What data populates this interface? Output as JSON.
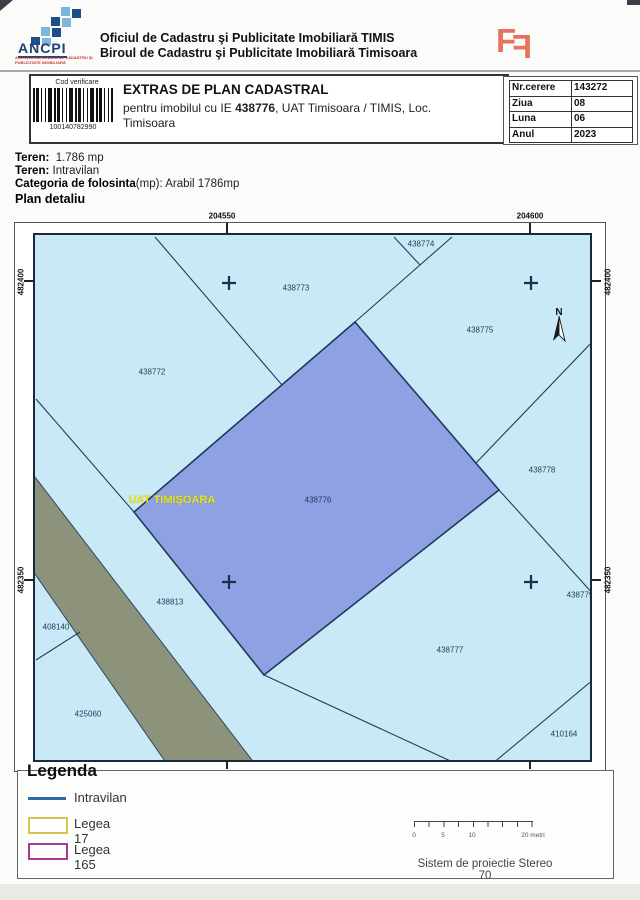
{
  "header": {
    "logo_acronym": "ANCPI",
    "logo_subtitle": "AGENŢIA NAŢIONALĂ DE CADASTRU ŞI PUBLICITATE IMOBILIARĂ",
    "office_line1": "Oficiul de Cadastru şi Publicitate Imobiliară TIMIS",
    "office_line2": "Biroul de Cadastru şi Publicitate Imobiliară Timisoara"
  },
  "title_box": {
    "cod_verificare": "Cod verificare",
    "barcode_number": "100140782990",
    "title": "EXTRAS DE PLAN CADASTRAL",
    "subtitle_prefix": "pentru imobilul cu IE ",
    "ie_number": "438776",
    "subtitle_suffix": ", UAT Timisoara / TIMIS, Loc.",
    "subtitle_line2": "Timisoara"
  },
  "request_table": [
    {
      "label": "Nr.cerere",
      "value": "143272"
    },
    {
      "label": "Ziua",
      "value": "08"
    },
    {
      "label": "Luna",
      "value": "06"
    },
    {
      "label": "Anul",
      "value": "2023"
    }
  ],
  "teren": {
    "label1": "Teren:",
    "value1": "1.786 mp",
    "label2": "Teren:",
    "value2": "Intravilan",
    "label3": "Categoria de folosinta",
    "label3b": "(mp):",
    "value3": "Arabil 1786mp",
    "plan_title": "Plan detaliu"
  },
  "map": {
    "grid_labels_top": [
      {
        "text": "204550",
        "x": 222,
        "y": 216
      },
      {
        "text": "204600",
        "x": 530,
        "y": 216
      }
    ],
    "grid_labels_bottom": [
      {
        "text": "204550",
        "x": 228,
        "y": 777
      },
      {
        "text": "204600",
        "x": 530,
        "y": 777
      }
    ],
    "grid_labels_left": [
      {
        "text": "482400",
        "x": 21,
        "y": 282
      },
      {
        "text": "482350",
        "x": 21,
        "y": 580
      }
    ],
    "grid_labels_right": [
      {
        "text": "482400",
        "x": 608,
        "y": 282
      },
      {
        "text": "482350",
        "x": 608,
        "y": 580
      }
    ],
    "parcels": [
      {
        "id": "438772",
        "x": 117,
        "y": 137
      },
      {
        "id": "438773",
        "x": 261,
        "y": 53
      },
      {
        "id": "438774",
        "x": 386,
        "y": 9
      },
      {
        "id": "438775",
        "x": 445,
        "y": 95
      },
      {
        "id": "438776",
        "x": 283,
        "y": 265
      },
      {
        "id": "438777",
        "x": 415,
        "y": 415
      },
      {
        "id": "438778",
        "x": 507,
        "y": 235
      },
      {
        "id": "438779",
        "x": 545,
        "y": 360
      },
      {
        "id": "438813",
        "x": 135,
        "y": 367
      },
      {
        "id": "408140",
        "x": 21,
        "y": 392
      },
      {
        "id": "425060",
        "x": 53,
        "y": 479
      },
      {
        "id": "410164",
        "x": 529,
        "y": 499
      }
    ],
    "uat_label": {
      "text": "UAT TIMIŞOARA",
      "x": 137,
      "y": 265
    },
    "north_label": "N",
    "crosses": [
      {
        "x": 194,
        "y": 48
      },
      {
        "x": 496,
        "y": 48
      },
      {
        "x": 194,
        "y": 347
      },
      {
        "x": 496,
        "y": 347
      }
    ]
  },
  "legend": {
    "title": "Legenda",
    "items": [
      {
        "label": "Intravilan",
        "swatch": "line",
        "color": "#2e6ca3"
      },
      {
        "label": "Legea 17",
        "swatch": "rect",
        "color": "#d2c553"
      },
      {
        "label": "Legea 165",
        "swatch": "rect",
        "color": "#a93a85"
      }
    ],
    "scale_labels": [
      {
        "text": "0",
        "x": 414
      },
      {
        "text": "5",
        "x": 443
      },
      {
        "text": "10",
        "x": 472
      },
      {
        "text": "20 metri",
        "x": 533
      }
    ],
    "projection": "Sistem de proiectie Stereo 70"
  },
  "colors": {
    "parcel_fill": "#c9e9f6",
    "main_parcel_fill": "#8fa0e3",
    "boundary": "#1d3d5e",
    "uat_text": "#e8e414",
    "logo_red": "#e4745e"
  }
}
